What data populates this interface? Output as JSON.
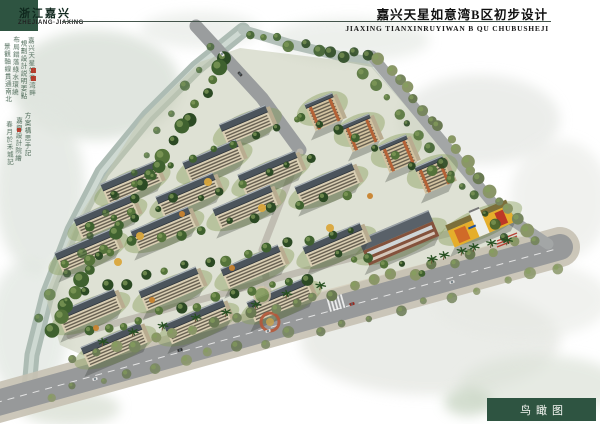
{
  "page": {
    "region_cn": "浙江嘉兴",
    "region_en": "ZHEJIANG·JIAXING",
    "title_cn": "嘉兴天星如意湾B区初步设计",
    "title_en": "JIAXING TIANXINRUYIWAN B QU CHUBUSHEJI",
    "caption": "鸟瞰图",
    "accent_green": "#2e5441"
  },
  "calligraphy": {
    "columns": [
      {
        "x": 26,
        "y": 37,
        "text": "嘉兴天星如意湾畔"
      },
      {
        "x": 18,
        "y": 40,
        "text": "規劃設計説明要點"
      },
      {
        "x": 10,
        "y": 36,
        "text": "布局錯落綠水環繞"
      },
      {
        "x": 2,
        "y": 43,
        "text": "景觀軸線貫通南北"
      },
      {
        "x": 22,
        "y": 112,
        "text": "方案構思手記"
      },
      {
        "x": 13,
        "y": 117,
        "text": "嘉興設計院繪"
      },
      {
        "x": 4,
        "y": 121,
        "text": "春月於禾城記"
      }
    ],
    "seals": [
      {
        "x": 31,
        "y": 68,
        "s": 5
      },
      {
        "x": 31,
        "y": 76,
        "s": 5
      },
      {
        "x": 17,
        "y": 128,
        "s": 4
      }
    ]
  },
  "scene": {
    "washes": [
      [
        95,
        85,
        85,
        55,
        "#dde3dc",
        0.9
      ],
      [
        40,
        190,
        45,
        85,
        "#e1e6e0",
        0.8
      ],
      [
        28,
        330,
        40,
        70,
        "#dfe5df",
        0.7
      ],
      [
        350,
        40,
        80,
        22,
        "#e6eae5",
        0.7
      ],
      [
        480,
        120,
        80,
        45,
        "#dcdfda",
        0.55
      ],
      [
        560,
        200,
        50,
        60,
        "#e2e4df",
        0.5
      ],
      [
        430,
        340,
        130,
        55,
        "#e4e6e1",
        0.75
      ],
      [
        540,
        385,
        80,
        30,
        "#dce2d8",
        0.7
      ],
      [
        200,
        30,
        60,
        18,
        "#e3e7e2",
        0.6
      ],
      [
        520,
        300,
        90,
        40,
        "#e7e9e4",
        0.6
      ],
      [
        70,
        408,
        50,
        18,
        "#d6ddd0",
        0.7
      ],
      [
        468,
        402,
        24,
        14,
        "#c9d6c4",
        0.8
      ]
    ],
    "ground": [
      [
        240,
        48
      ],
      [
        370,
        64
      ],
      [
        470,
        180
      ],
      [
        520,
        230
      ],
      [
        540,
        248
      ],
      [
        420,
        290
      ],
      [
        300,
        330
      ],
      [
        120,
        372
      ],
      [
        60,
        345
      ],
      [
        45,
        295
      ],
      [
        80,
        215
      ],
      [
        140,
        120
      ],
      [
        200,
        62
      ]
    ],
    "ground_color": "#c2c8b0",
    "water": [
      {
        "pts": [
          [
            243,
            30
          ],
          [
            196,
            68
          ],
          [
            148,
            116
          ],
          [
            102,
            172
          ],
          [
            72,
            230
          ],
          [
            47,
            295
          ],
          [
            32,
            355
          ],
          [
            28,
            400
          ]
        ],
        "w": 15,
        "c": "#adbcb4",
        "o": 1
      },
      {
        "pts": [
          [
            243,
            30
          ],
          [
            196,
            68
          ],
          [
            148,
            116
          ],
          [
            102,
            172
          ],
          [
            72,
            230
          ],
          [
            47,
            295
          ],
          [
            32,
            355
          ],
          [
            28,
            400
          ]
        ],
        "w": 5,
        "c": "#d2dcd5",
        "o": 0.9
      },
      {
        "pts": [
          [
            243,
            30
          ],
          [
            290,
            44
          ],
          [
            340,
            56
          ],
          [
            372,
            62
          ]
        ],
        "w": 10,
        "c": "#b3c0b9",
        "o": 1
      },
      {
        "pts": [
          [
            372,
            62
          ],
          [
            430,
            128
          ],
          [
            470,
            175
          ]
        ],
        "w": 8,
        "c": "#bcc8c1",
        "o": 0.6
      }
    ],
    "plaza": [
      [
        318,
        292
      ],
      [
        430,
        262
      ],
      [
        520,
        236
      ],
      [
        545,
        248
      ],
      [
        440,
        280
      ],
      [
        330,
        318
      ]
    ],
    "plaza_color": "#d7d1c0",
    "roads": [
      {
        "pts": [
          [
            -10,
            405
          ],
          [
            560,
            247
          ]
        ],
        "w": 40,
        "c": "#c6c1b3",
        "o": 0.9
      },
      {
        "pts": [
          [
            -10,
            405
          ],
          [
            560,
            247
          ]
        ],
        "w": 26,
        "c": "#97999a",
        "o": 1
      },
      {
        "pts": [
          [
            372,
            56
          ],
          [
            500,
            212
          ],
          [
            548,
            244
          ]
        ],
        "w": 11,
        "c": "#a3a6a6",
        "o": 1
      },
      {
        "pts": [
          [
            196,
            26
          ],
          [
            262,
            98
          ],
          [
            300,
            150
          ]
        ],
        "w": 13,
        "c": "#9a9d9e",
        "o": 1
      },
      {
        "pts": [
          [
            300,
            152
          ],
          [
            262,
            250
          ],
          [
            272,
            318
          ]
        ],
        "w": 7,
        "c": "#bcb9ae",
        "o": 0.9
      },
      {
        "pts": [
          [
            70,
            336
          ],
          [
            336,
            262
          ],
          [
            470,
            228
          ]
        ],
        "w": 7,
        "c": "#bcb9ae",
        "o": 0.9
      }
    ],
    "dash": {
      "pts": [
        [
          -5,
          403
        ],
        [
          556,
          249
        ]
      ],
      "c": "#ececec"
    },
    "buildings": [
      {
        "t": "res",
        "x": 113,
        "y": 342,
        "w": 64
      },
      {
        "t": "res",
        "x": 196,
        "y": 319,
        "w": 64
      },
      {
        "t": "res",
        "x": 279,
        "y": 297,
        "w": 64
      },
      {
        "t": "res",
        "x": 88,
        "y": 308,
        "w": 62
      },
      {
        "t": "res",
        "x": 170,
        "y": 286,
        "w": 62
      },
      {
        "t": "res",
        "x": 252,
        "y": 264,
        "w": 62
      },
      {
        "t": "res",
        "x": 334,
        "y": 242,
        "w": 62
      },
      {
        "t": "res",
        "x": 86,
        "y": 248,
        "w": 62
      },
      {
        "t": "res",
        "x": 162,
        "y": 226,
        "w": 62
      },
      {
        "t": "res",
        "x": 244,
        "y": 204,
        "w": 62
      },
      {
        "t": "res",
        "x": 326,
        "y": 182,
        "w": 62
      },
      {
        "t": "res",
        "x": 105,
        "y": 214,
        "w": 62
      },
      {
        "t": "res",
        "x": 187,
        "y": 192,
        "w": 62
      },
      {
        "t": "res",
        "x": 269,
        "y": 170,
        "w": 62
      },
      {
        "t": "res",
        "x": 130,
        "y": 180,
        "w": 58
      },
      {
        "t": "res",
        "x": 212,
        "y": 158,
        "w": 58
      },
      {
        "t": "res",
        "x": 245,
        "y": 122,
        "w": 50
      },
      {
        "t": "tower",
        "x": 320,
        "y": 103,
        "w": 30
      },
      {
        "t": "tower",
        "x": 357,
        "y": 124,
        "w": 30
      },
      {
        "t": "tower",
        "x": 394,
        "y": 145,
        "w": 30
      },
      {
        "t": "tower",
        "x": 430,
        "y": 166,
        "w": 30
      },
      {
        "t": "shop",
        "x": 398,
        "y": 236,
        "w": 76
      },
      {
        "t": "kind",
        "x": 478,
        "y": 218,
        "w": 66
      }
    ],
    "rot": -23,
    "palette": {
      "roof": "#4b545c",
      "ridge": "#aab2b8",
      "eave": "#2e343a",
      "facade": "#d8cdb2",
      "win": "#564f42",
      "end": "#b9ac90",
      "lawn": "#8aa05e",
      "tower_facade": "#d2c2a0",
      "tower_accent": "#b56236",
      "brick": "#84523c",
      "glass": "#cfd6d8",
      "kind_body": "#e5ae2b",
      "kind_orange": "#d06a28",
      "kind_red": "#bd3826",
      "white": "#eceee9",
      "shadow": "rgba(45,52,48,0.30)"
    },
    "tree_lines": [
      {
        "a": [
          228,
          58
        ],
        "b": [
          50,
          330
        ],
        "n": 24,
        "r": [
          4,
          8
        ],
        "o": 1
      },
      {
        "a": [
          212,
          48
        ],
        "b": [
          38,
          318
        ],
        "n": 14,
        "r": [
          3,
          6
        ],
        "o": 0.75
      },
      {
        "a": [
          252,
          36
        ],
        "b": [
          368,
          58
        ],
        "n": 10,
        "r": [
          3,
          6
        ],
        "o": 0.9
      },
      {
        "a": [
          380,
          60
        ],
        "b": [
          525,
          228
        ],
        "n": 18,
        "r": [
          4,
          7
        ],
        "o": 1,
        "olive": true
      },
      {
        "a": [
          366,
          74
        ],
        "b": [
          508,
          235
        ],
        "n": 14,
        "r": [
          3,
          6
        ],
        "o": 0.9
      },
      {
        "a": [
          75,
          360
        ],
        "b": [
          532,
          240
        ],
        "n": 24,
        "r": [
          4,
          6
        ],
        "o": 1,
        "olive": true
      },
      {
        "a": [
          48,
          396
        ],
        "b": [
          560,
          268
        ],
        "n": 20,
        "r": [
          3,
          6
        ],
        "o": 0.85,
        "olive": true
      },
      {
        "a": [
          88,
          332
        ],
        "b": [
          305,
          278
        ],
        "n": 13,
        "r": [
          3,
          6
        ],
        "o": 1
      },
      {
        "a": [
          66,
          298
        ],
        "b": [
          350,
          228
        ],
        "n": 15,
        "r": [
          3,
          6
        ],
        "o": 1
      },
      {
        "a": [
          64,
          262
        ],
        "b": [
          345,
          192
        ],
        "n": 13,
        "r": [
          3,
          6
        ],
        "o": 1
      },
      {
        "a": [
          88,
          228
        ],
        "b": [
          310,
          162
        ],
        "n": 11,
        "r": [
          3,
          5
        ],
        "o": 1
      },
      {
        "a": [
          112,
          194
        ],
        "b": [
          298,
          116
        ],
        "n": 10,
        "r": [
          3,
          5
        ],
        "o": 1
      },
      {
        "a": [
          300,
          118
        ],
        "b": [
          452,
          178
        ],
        "n": 9,
        "r": [
          3,
          6
        ],
        "o": 1
      },
      {
        "a": [
          336,
          252
        ],
        "b": [
          420,
          270
        ],
        "n": 6,
        "r": [
          3,
          5
        ],
        "o": 1
      }
    ],
    "palm_lines": [
      {
        "a": [
          102,
          346
        ],
        "b": [
          318,
          292
        ],
        "n": 8
      },
      {
        "a": [
          430,
          262
        ],
        "b": [
          505,
          246
        ],
        "n": 6
      }
    ],
    "autumn": [
      [
        152,
        300
      ],
      [
        118,
        262
      ],
      [
        232,
        268
      ],
      [
        262,
        208
      ],
      [
        182,
        214
      ],
      [
        330,
        228
      ],
      [
        96,
        328
      ],
      [
        208,
        182
      ],
      [
        370,
        196
      ],
      [
        140,
        236
      ]
    ],
    "tree_colors": [
      "#2c4a24",
      "#3f612f",
      "#54733a"
    ],
    "olive_colors": [
      "#77865f",
      "#8a9668",
      "#697952"
    ],
    "autumn_colors": [
      "#c8832e",
      "#d9a73c"
    ],
    "cars_main": [
      {
        "x": 95,
        "y": 379,
        "c": "#e8e8e8"
      },
      {
        "x": 180,
        "y": 350,
        "c": "#2e2e2e"
      },
      {
        "x": 268,
        "y": 331,
        "c": "#e0e0e0"
      },
      {
        "x": 352,
        "y": 304,
        "c": "#99281e"
      },
      {
        "x": 452,
        "y": 282,
        "c": "#dcdcdc"
      }
    ],
    "cars_top": [
      {
        "x": 222,
        "y": 54,
        "c": "#e8e8e8"
      },
      {
        "x": 240,
        "y": 74,
        "c": "#3a3a3a"
      }
    ],
    "road_angle": -15.5,
    "top_road_angle": 47,
    "features": {
      "entrance_ring": {
        "x": 270,
        "y": 322,
        "r": 9,
        "c": "#b5593a"
      },
      "entrance_core": {
        "x": 270,
        "y": 322,
        "r": 4,
        "c": "#c8a24e"
      },
      "plaza_circle": {
        "x": 262,
        "y": 295,
        "r": 8,
        "ring": "#cbbfa2",
        "fill": "#7d9553"
      },
      "red_steps": [
        [
          497,
          241
        ],
        [
          517,
          233
        ]
      ],
      "crosswalk": {
        "x": 336,
        "y": 303
      }
    }
  }
}
